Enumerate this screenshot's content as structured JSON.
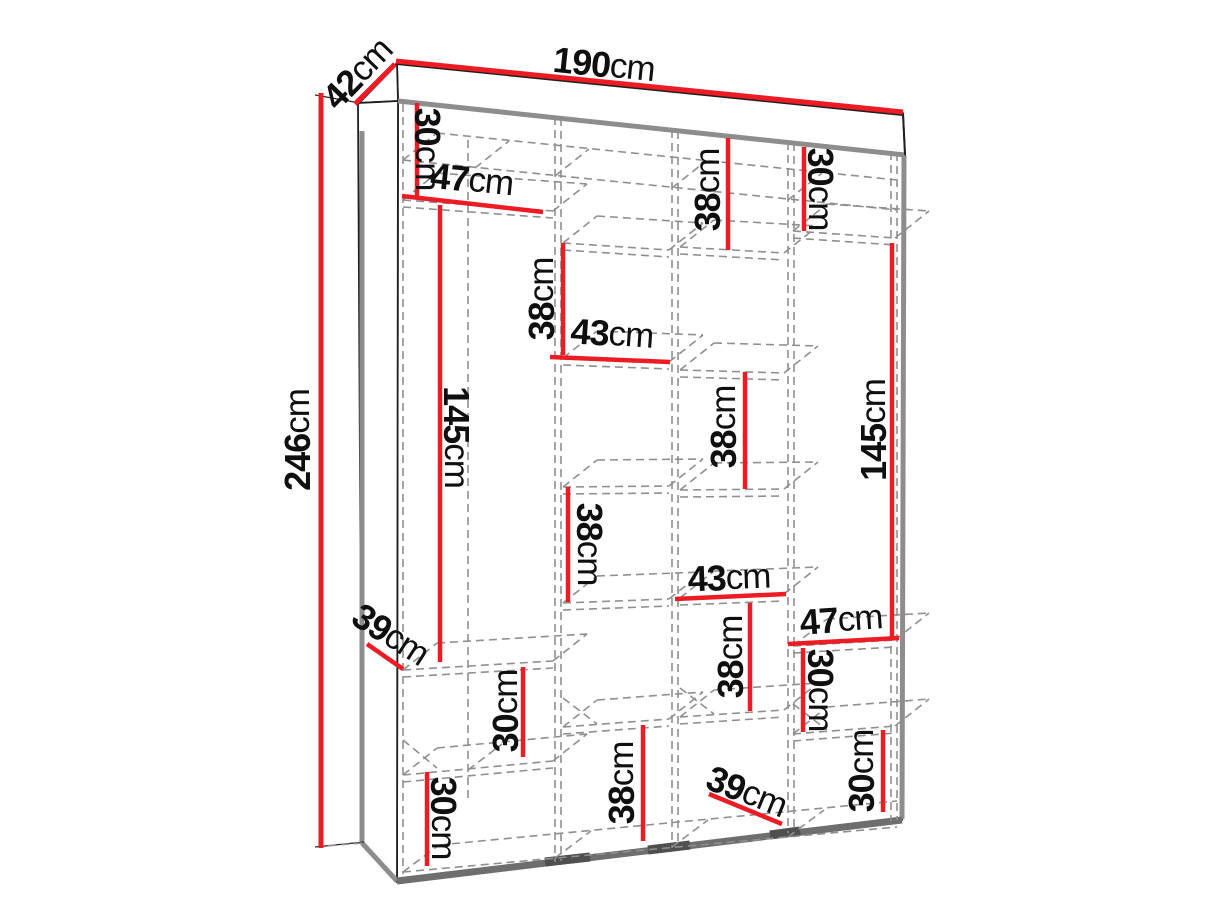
{
  "figure": {
    "kind": "wardrobe-dimension-diagram",
    "unit": "cm",
    "colors": {
      "dimension_line": "#ed1c24",
      "outline": "#1f1f1f",
      "hidden_line": "#8f8f8f"
    }
  },
  "dimensions": {
    "overall": {
      "width": {
        "num": "190",
        "unit": "cm",
        "text": "190cm"
      },
      "depth": {
        "num": "42",
        "unit": "cm",
        "text": "42cm"
      },
      "height": {
        "num": "246",
        "unit": "cm",
        "text": "246cm"
      }
    },
    "internal": {
      "c1_top_shelf_height": {
        "num": "30",
        "unit": "cm",
        "text": "30cm"
      },
      "c1_top_width": {
        "num": "47",
        "unit": "cm",
        "text": "47cm"
      },
      "c1_hanging_height": {
        "num": "145",
        "unit": "cm",
        "text": "145cm"
      },
      "c1_shelf_depth": {
        "num": "39",
        "unit": "cm",
        "text": "39cm"
      },
      "c1_lower_shelf_height": {
        "num": "30",
        "unit": "cm",
        "text": "30cm"
      },
      "c1_bottom_shelf_height": {
        "num": "30",
        "unit": "cm",
        "text": "30cm"
      },
      "c2_upper_shelf_height": {
        "num": "38",
        "unit": "cm",
        "text": "38cm"
      },
      "c2_width": {
        "num": "43",
        "unit": "cm",
        "text": "43cm"
      },
      "c2_middle_shelf_height": {
        "num": "38",
        "unit": "cm",
        "text": "38cm"
      },
      "c2_bottom_shelf_height": {
        "num": "38",
        "unit": "cm",
        "text": "38cm"
      },
      "c3_top_shelf_height": {
        "num": "38",
        "unit": "cm",
        "text": "38cm"
      },
      "c3_middle_shelf_height": {
        "num": "38",
        "unit": "cm",
        "text": "38cm"
      },
      "c3_width": {
        "num": "43",
        "unit": "cm",
        "text": "43cm"
      },
      "c3_lower_shelf_height": {
        "num": "38",
        "unit": "cm",
        "text": "38cm"
      },
      "c3_shelf_depth": {
        "num": "39",
        "unit": "cm",
        "text": "39cm"
      },
      "c4_top_shelf_height": {
        "num": "30",
        "unit": "cm",
        "text": "30cm"
      },
      "c4_hanging_height": {
        "num": "145",
        "unit": "cm",
        "text": "145cm"
      },
      "c4_width": {
        "num": "47",
        "unit": "cm",
        "text": "47cm"
      },
      "c4_lower_shelf_height": {
        "num": "30",
        "unit": "cm",
        "text": "30cm"
      },
      "c4_bottom_shelf_height": {
        "num": "30",
        "unit": "cm",
        "text": "30cm"
      }
    }
  }
}
